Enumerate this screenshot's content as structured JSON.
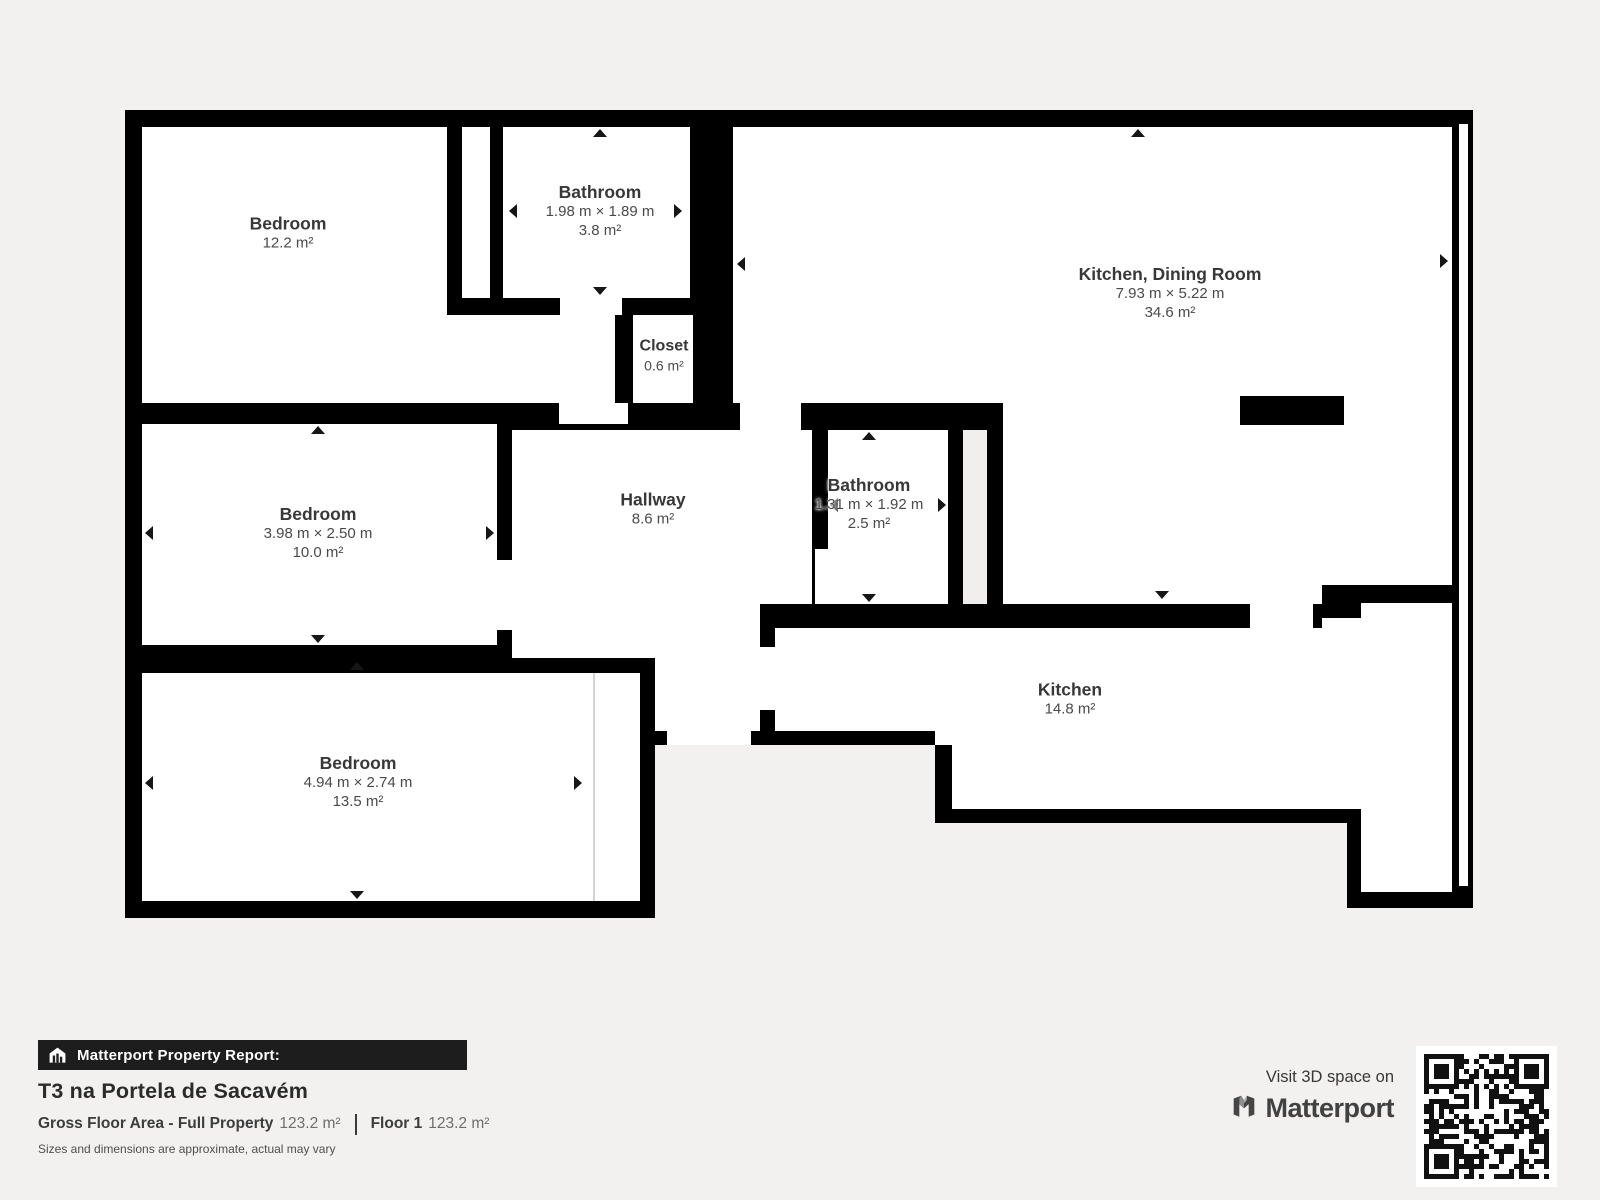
{
  "page": {
    "background": "#f2f1ef"
  },
  "plan": {
    "wall_color": "#000000",
    "floor_color": "#ffffff",
    "rooms": [
      {
        "id": "bedroom-1",
        "name": "Bedroom",
        "area": "12.2 m²"
      },
      {
        "id": "bathroom-1",
        "name": "Bathroom",
        "dims": "1.98 m × 1.89 m",
        "area": "3.8 m²"
      },
      {
        "id": "kitchen-dining-room",
        "name": "Kitchen, Dining Room",
        "dims": "7.93 m × 5.22 m",
        "area": "34.6 m²"
      },
      {
        "id": "closet",
        "name": "Closet",
        "area": "0.6 m²"
      },
      {
        "id": "bedroom-2",
        "name": "Bedroom",
        "dims": "3.98 m × 2.50 m",
        "area": "10.0 m²"
      },
      {
        "id": "hallway",
        "name": "Hallway",
        "area": "8.6 m²"
      },
      {
        "id": "bathroom-2",
        "name": "Bathroom",
        "dims": "1.31 m × 1.92 m",
        "area": "2.5 m²"
      },
      {
        "id": "kitchen",
        "name": "Kitchen",
        "area": "14.8 m²"
      },
      {
        "id": "bedroom-3",
        "name": "Bedroom",
        "dims": "4.94 m × 2.74 m",
        "area": "13.5 m²"
      }
    ]
  },
  "report": {
    "bar_label": "Matterport Property Report:",
    "title": "T3 na Portela de Sacavém",
    "gfa_label": "Gross Floor Area - Full Property",
    "gfa_value": "123.2 m²",
    "floor_label": "Floor 1",
    "floor_value": "123.2 m²",
    "disclaimer": "Sizes and dimensions are approximate, actual may vary"
  },
  "promo": {
    "visit_text": "Visit 3D space on",
    "brand": "Matterport"
  },
  "icons": {
    "report_bar": "house-icon",
    "brand": "matterport-logo-icon",
    "qr": "qr-code"
  }
}
